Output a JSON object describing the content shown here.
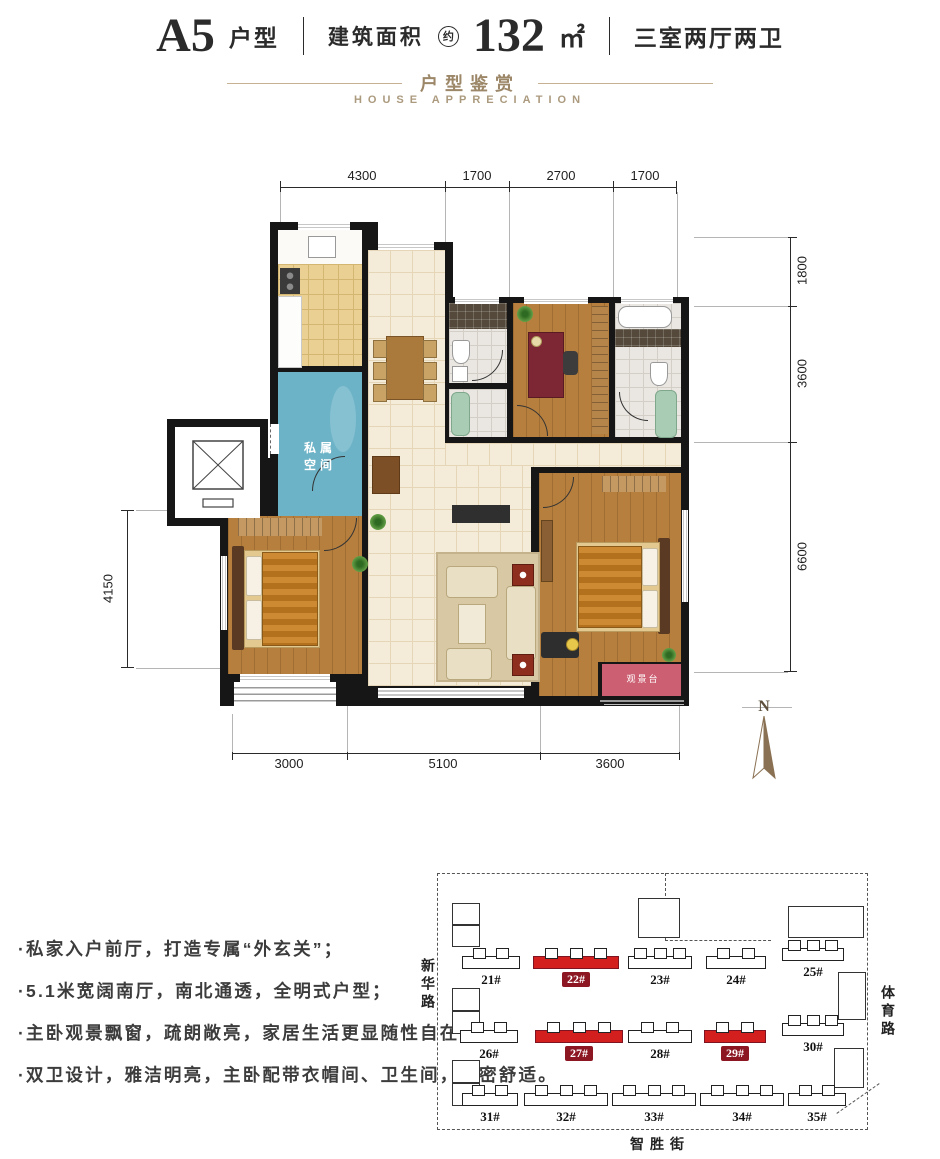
{
  "header": {
    "unit_code": "A5",
    "unit_type": "户型",
    "area_label": "建筑面积",
    "approx": "约",
    "area_value": "132",
    "area_unit": "㎡",
    "layout": "三室两厅两卫"
  },
  "section": {
    "title_cn": "户型鉴赏",
    "title_en": "HOUSE APPRECIATION"
  },
  "plan": {
    "dims_top": [
      "4300",
      "1700",
      "2700",
      "1700"
    ],
    "dims_right": [
      "1800",
      "3600",
      "6600"
    ],
    "dim_left": "4150",
    "dims_bottom": [
      "3000",
      "5100",
      "3600"
    ],
    "labels": {
      "private_space": "私属空间",
      "bay": "观景台"
    },
    "compass_label": "N"
  },
  "features": [
    "·私家入户前厅，打造专属“外玄关”；",
    "·5.1米宽阔南厅，南北通透，全明式户型；",
    "·主卧观景飘窗，疏朗敞亮，家居生活更显随性自在；",
    "·双卫设计，雅洁明亮，主卧配带衣帽间、卫生间，私密舒适。"
  ],
  "siteplan": {
    "road_left": "新华路",
    "road_right": "体育路",
    "road_bottom": "智胜街",
    "rows": [
      [
        {
          "label": "21#",
          "hl": false
        },
        {
          "label": "22#",
          "hl": true
        },
        {
          "label": "23#",
          "hl": false
        },
        {
          "label": "24#",
          "hl": false
        },
        {
          "label": "25#",
          "hl": false
        }
      ],
      [
        {
          "label": "26#",
          "hl": false
        },
        {
          "label": "27#",
          "hl": true
        },
        {
          "label": "28#",
          "hl": false
        },
        {
          "label": "29#",
          "hl": true
        },
        {
          "label": "30#",
          "hl": false
        }
      ],
      [
        {
          "label": "31#",
          "hl": false
        },
        {
          "label": "32#",
          "hl": false
        },
        {
          "label": "33#",
          "hl": false
        },
        {
          "label": "34#",
          "hl": false
        },
        {
          "label": "35#",
          "hl": false
        }
      ]
    ]
  },
  "colors": {
    "accent_gold": "#9c8768",
    "highlight_red": "#d41f1f",
    "label_red": "#8c1622",
    "foyer_blue": "#6db3c7",
    "bay_pink": "#cc6072"
  }
}
